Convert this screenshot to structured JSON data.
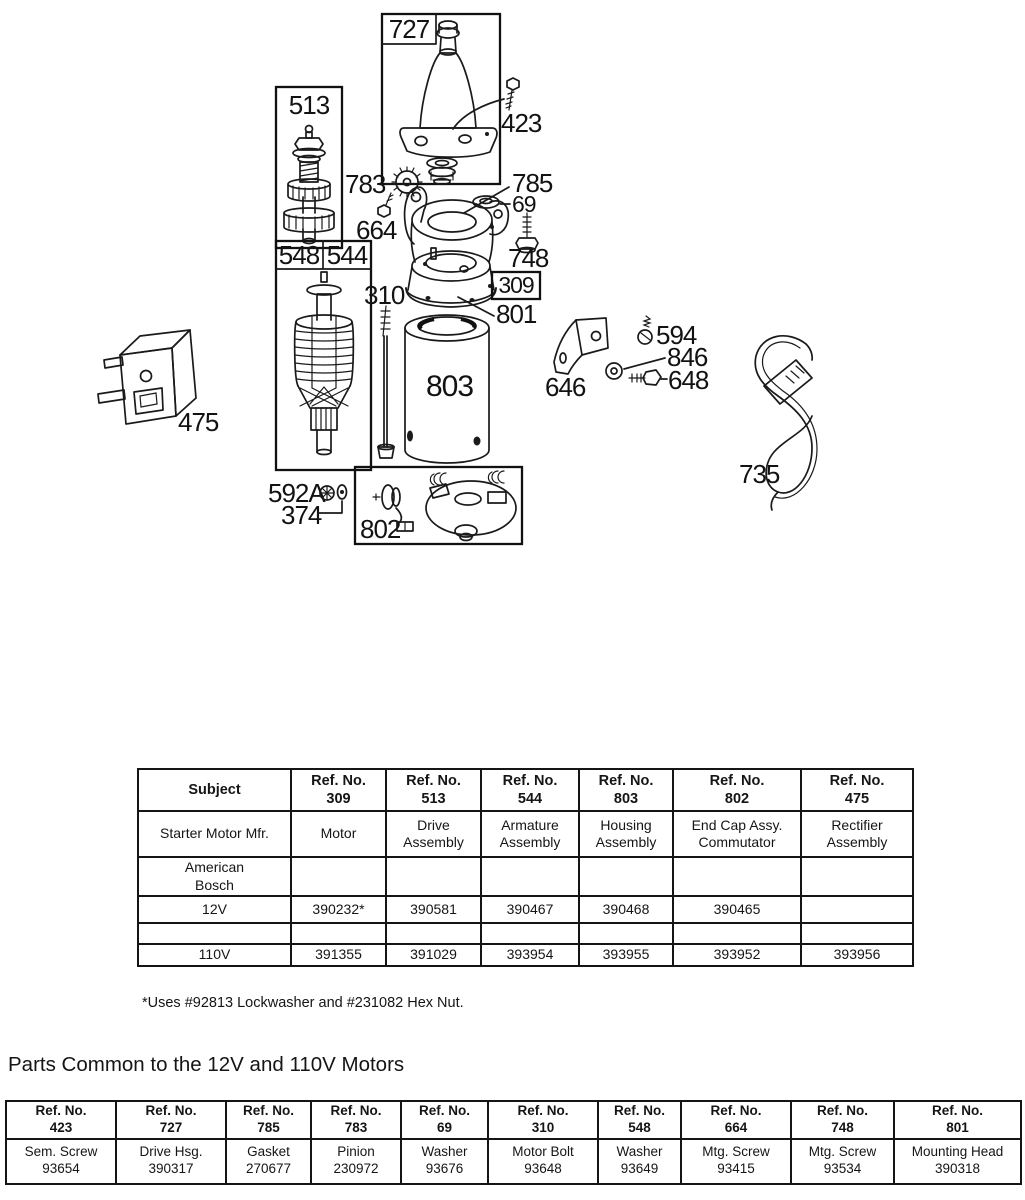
{
  "page": {
    "note": "*Uses #92813 Lockwasher and #231082 Hex Nut.",
    "common_heading": "Parts Common to the 12V and 110V Motors"
  },
  "diagram": {
    "callouts": {
      "b727": "727",
      "b513": "513",
      "b548": "548",
      "b544": "544",
      "b309": "309",
      "b802": "802",
      "n423": "423",
      "n783": "783",
      "n664": "664",
      "n785": "785",
      "n69": "69",
      "n748": "748",
      "n801": "801",
      "n310": "310",
      "n803": "803",
      "n592a": "592A",
      "n374": "374",
      "n646": "646",
      "n594": "594",
      "n846": "846",
      "n648": "648",
      "n475": "475",
      "n735": "735"
    }
  },
  "parts_table": {
    "headers": [
      "Subject",
      "Ref. No.\n309",
      "Ref. No.\n513",
      "Ref. No.\n544",
      "Ref. No.\n803",
      "Ref. No.\n802",
      "Ref. No.\n475"
    ],
    "rows": [
      [
        "Starter Motor Mfr.",
        "Motor",
        "Drive\nAssembly",
        "Armature\nAssembly",
        "Housing\nAssembly",
        "End Cap Assy.\nCommutator",
        "Rectifier\nAssembly"
      ],
      [
        "American\nBosch",
        "",
        "",
        "",
        "",
        "",
        ""
      ],
      [
        "12V",
        "390232*",
        "390581",
        "390467",
        "390468",
        "390465",
        ""
      ],
      [
        "",
        "",
        "",
        "",
        "",
        "",
        ""
      ],
      [
        "110V",
        "391355",
        "391029",
        "393954",
        "393955",
        "393952",
        "393956"
      ]
    ]
  },
  "common_table": {
    "headers": [
      "Ref. No.\n423",
      "Ref. No.\n727",
      "Ref. No.\n785",
      "Ref. No.\n783",
      "Ref. No.\n69",
      "Ref. No.\n310",
      "Ref. No.\n548",
      "Ref. No.\n664",
      "Ref. No.\n748",
      "Ref. No.\n801"
    ],
    "cells": [
      "Sem. Screw\n93654",
      "Drive Hsg.\n390317",
      "Gasket\n270677",
      "Pinion\n230972",
      "Washer\n93676",
      "Motor Bolt\n93648",
      "Washer\n93649",
      "Mtg. Screw\n93415",
      "Mtg. Screw\n93534",
      "Mounting Head\n390318"
    ]
  }
}
